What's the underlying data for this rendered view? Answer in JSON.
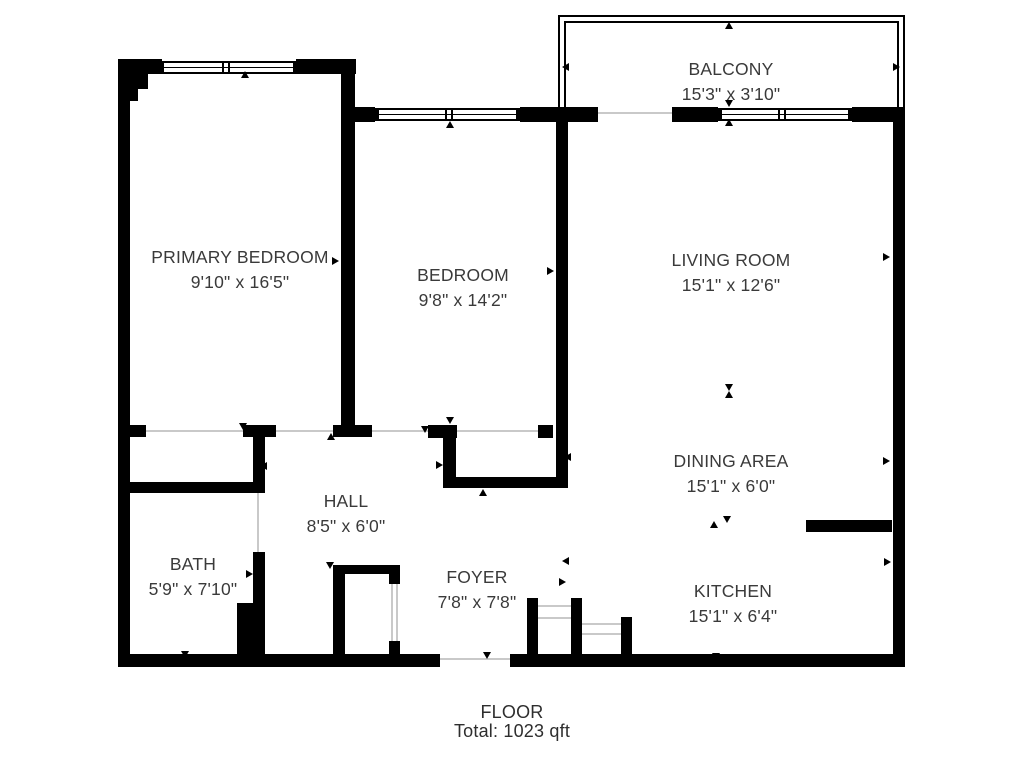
{
  "footer": {
    "line1": "FLOOR",
    "line2": "Total: 1023 qft"
  },
  "colors": {
    "wall": "#000000",
    "text": "#3a3a3a",
    "opening_line": "#c9c9c9"
  },
  "plan": {
    "rooms": [
      {
        "id": "balcony",
        "name": "BALCONY",
        "dims": "15'3\" x 3'10\"",
        "cx": 731,
        "cy": 82
      },
      {
        "id": "primary-bedroom",
        "name": "PRIMARY BEDROOM",
        "dims": "9'10\" x 16'5\"",
        "cx": 240,
        "cy": 270
      },
      {
        "id": "bedroom",
        "name": "BEDROOM",
        "dims": "9'8\" x 14'2\"",
        "cx": 463,
        "cy": 288
      },
      {
        "id": "living-room",
        "name": "LIVING ROOM",
        "dims": "15'1\" x 12'6\"",
        "cx": 731,
        "cy": 273
      },
      {
        "id": "dining-area",
        "name": "DINING AREA",
        "dims": "15'1\" x 6'0\"",
        "cx": 731,
        "cy": 474
      },
      {
        "id": "hall",
        "name": "HALL",
        "dims": "8'5\" x 6'0\"",
        "cx": 346,
        "cy": 514
      },
      {
        "id": "bath",
        "name": "BATH",
        "dims": "5'9\" x 7'10\"",
        "cx": 193,
        "cy": 577
      },
      {
        "id": "foyer",
        "name": "FOYER",
        "dims": "7'8\" x 7'8\"",
        "cx": 477,
        "cy": 590
      },
      {
        "id": "kitchen",
        "name": "KITCHEN",
        "dims": "15'1\" x 6'4\"",
        "cx": 733,
        "cy": 604
      }
    ],
    "walls": [
      [
        118,
        59,
        12,
        607
      ],
      [
        118,
        59,
        30,
        30
      ],
      [
        118,
        85,
        20,
        16
      ],
      [
        118,
        59,
        44,
        15
      ],
      [
        296,
        59,
        60,
        15
      ],
      [
        341,
        59,
        14,
        378
      ],
      [
        341,
        107,
        34,
        15
      ],
      [
        520,
        107,
        48,
        15
      ],
      [
        556,
        107,
        42,
        15
      ],
      [
        672,
        107,
        46,
        15
      ],
      [
        852,
        107,
        53,
        15
      ],
      [
        893,
        107,
        12,
        560
      ],
      [
        118,
        654,
        322,
        13
      ],
      [
        510,
        654,
        395,
        13
      ],
      [
        556,
        107,
        12,
        381
      ],
      [
        118,
        425,
        28,
        12
      ],
      [
        243,
        425,
        33,
        12
      ],
      [
        333,
        425,
        39,
        12
      ],
      [
        428,
        425,
        29,
        13
      ],
      [
        538,
        425,
        15,
        13
      ],
      [
        253,
        425,
        12,
        68
      ],
      [
        118,
        482,
        147,
        11
      ],
      [
        253,
        552,
        12,
        114
      ],
      [
        237,
        603,
        28,
        57
      ],
      [
        443,
        425,
        13,
        63
      ],
      [
        443,
        477,
        122,
        11
      ],
      [
        333,
        565,
        12,
        101
      ],
      [
        333,
        565,
        67,
        9
      ],
      [
        389,
        574,
        11,
        10
      ],
      [
        389,
        641,
        11,
        25
      ],
      [
        527,
        598,
        11,
        62
      ],
      [
        571,
        598,
        11,
        62
      ],
      [
        621,
        617,
        11,
        49
      ],
      [
        806,
        520,
        86,
        12
      ]
    ],
    "openings": [
      [
        146,
        430,
        97,
        2
      ],
      [
        276,
        430,
        57,
        2
      ],
      [
        372,
        430,
        56,
        2
      ],
      [
        457,
        430,
        81,
        2
      ],
      [
        257,
        493,
        2,
        59
      ],
      [
        440,
        658,
        70,
        2
      ],
      [
        598,
        112,
        74,
        2
      ],
      [
        391,
        584,
        2,
        57
      ],
      [
        396,
        584,
        2,
        57
      ],
      [
        538,
        605,
        33,
        2
      ],
      [
        538,
        617,
        33,
        2
      ],
      [
        582,
        623,
        39,
        2
      ],
      [
        582,
        633,
        39,
        2
      ]
    ],
    "windows": [
      {
        "rect": [
          160,
          61,
          137,
          13
        ],
        "mullions": [
          60,
          66
        ]
      },
      {
        "rect": [
          375,
          108,
          145,
          13
        ],
        "mullions": [
          68,
          74
        ]
      },
      {
        "rect": [
          718,
          108,
          134,
          13
        ],
        "mullions": [
          58,
          64
        ]
      }
    ],
    "balcony_rails": [
      [
        558,
        15,
        347,
        95
      ],
      [
        564,
        21,
        335,
        89
      ]
    ],
    "arrows": [
      {
        "d": "up",
        "x": 729,
        "y": 26
      },
      {
        "d": "left",
        "x": 566,
        "y": 67
      },
      {
        "d": "right",
        "x": 897,
        "y": 67
      },
      {
        "d": "down",
        "x": 729,
        "y": 104
      },
      {
        "d": "up",
        "x": 729,
        "y": 123
      },
      {
        "d": "up",
        "x": 245,
        "y": 75
      },
      {
        "d": "up",
        "x": 450,
        "y": 125
      },
      {
        "d": "left",
        "x": 125,
        "y": 261
      },
      {
        "d": "right",
        "x": 336,
        "y": 261
      },
      {
        "d": "left",
        "x": 350,
        "y": 275
      },
      {
        "d": "right",
        "x": 551,
        "y": 271
      },
      {
        "d": "right",
        "x": 887,
        "y": 257
      },
      {
        "d": "down",
        "x": 729,
        "y": 388
      },
      {
        "d": "up",
        "x": 729,
        "y": 395
      },
      {
        "d": "right",
        "x": 887,
        "y": 461
      },
      {
        "d": "up",
        "x": 714,
        "y": 525
      },
      {
        "d": "down",
        "x": 727,
        "y": 520
      },
      {
        "d": "right",
        "x": 888,
        "y": 562
      },
      {
        "d": "down",
        "x": 716,
        "y": 657
      },
      {
        "d": "left",
        "x": 123,
        "y": 572
      },
      {
        "d": "right",
        "x": 250,
        "y": 574
      },
      {
        "d": "up",
        "x": 190,
        "y": 488
      },
      {
        "d": "left",
        "x": 264,
        "y": 466
      },
      {
        "d": "up",
        "x": 331,
        "y": 437
      },
      {
        "d": "down",
        "x": 425,
        "y": 430
      },
      {
        "d": "down",
        "x": 243,
        "y": 427
      },
      {
        "d": "down",
        "x": 450,
        "y": 421
      },
      {
        "d": "up",
        "x": 483,
        "y": 493
      },
      {
        "d": "right",
        "x": 440,
        "y": 465
      },
      {
        "d": "left",
        "x": 568,
        "y": 457
      },
      {
        "d": "left",
        "x": 566,
        "y": 561
      },
      {
        "d": "right",
        "x": 563,
        "y": 582
      },
      {
        "d": "down",
        "x": 330,
        "y": 566
      },
      {
        "d": "down",
        "x": 487,
        "y": 656
      },
      {
        "d": "down",
        "x": 185,
        "y": 655
      }
    ]
  }
}
